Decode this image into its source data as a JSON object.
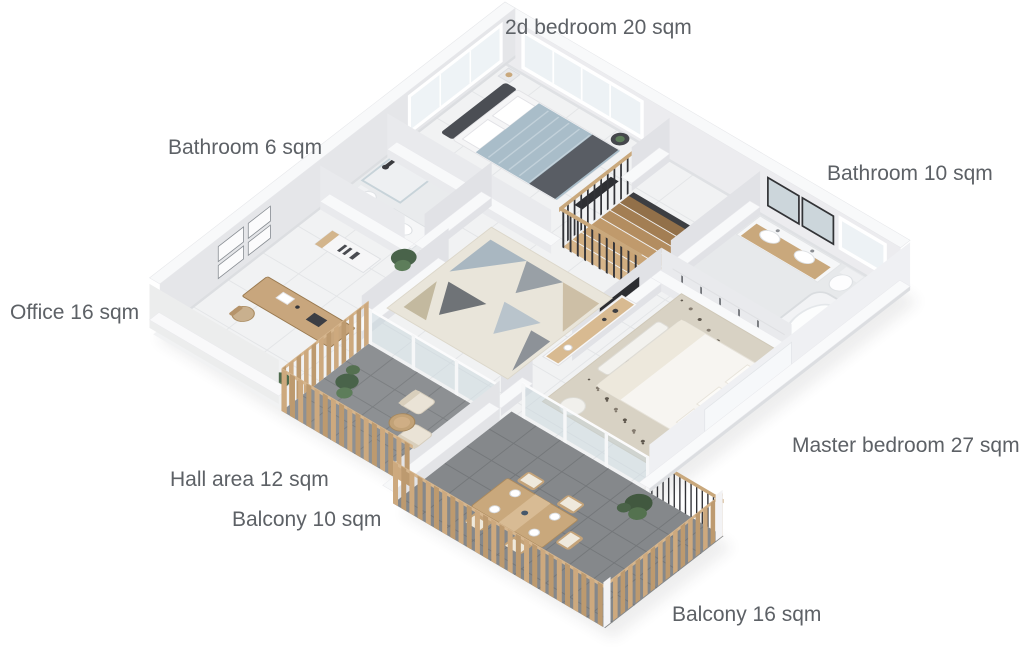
{
  "page": {
    "background": "#ffffff"
  },
  "floor_plan": {
    "type": "isometric-3d-apartment-floor-plan",
    "labels": {
      "bedroom2": "2d bedroom 20 sqm",
      "bathroom6": "Bathroom 6 sqm",
      "bathroom10": "Bathroom 10 sqm",
      "office": "Office 16 sqm",
      "master_bedroom": "Master bedroom 27 sqm",
      "hall": "Hall area 12 sqm",
      "balcony10": "Balcony 10 sqm",
      "balcony16": "Balcony 16 sqm"
    },
    "colors": {
      "label_text": "#5d6166",
      "interior_floor": "#f1f2f3",
      "balcony_floor": "#8d9093",
      "wall_white": "#ececef",
      "wood": "#c9a87c",
      "bedding_blue": "#a9bdc9",
      "dark_furniture": "#4b4e54",
      "plant_green": "#4e6b4d"
    }
  }
}
